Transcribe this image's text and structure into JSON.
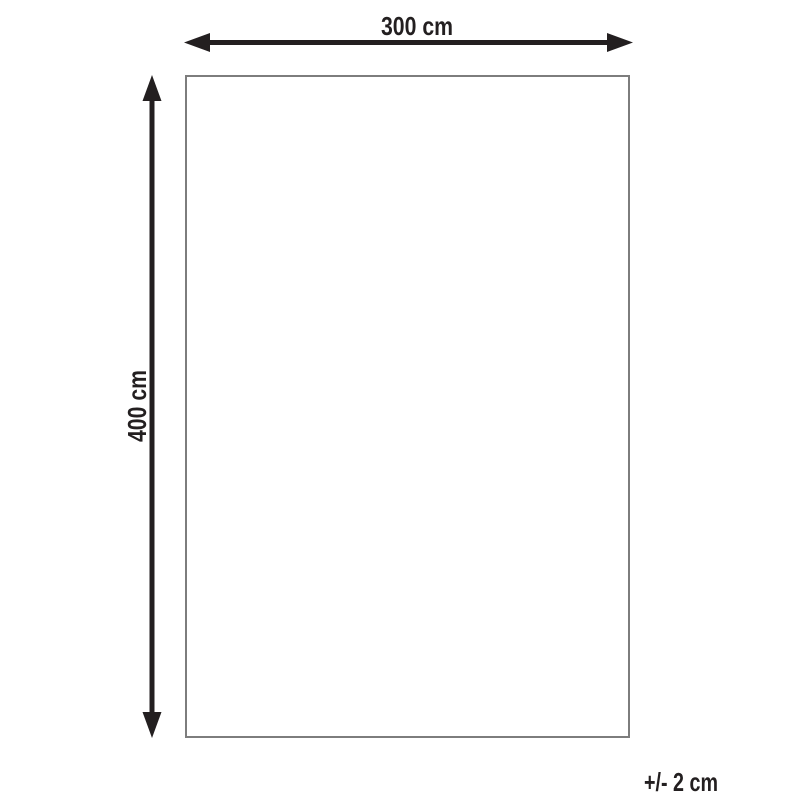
{
  "diagram": {
    "type": "product-dimension-diagram",
    "width_label": "300 cm",
    "height_label": "400 cm",
    "tolerance_label": "+/- 2 cm",
    "colors": {
      "arrow": "#231f20",
      "text": "#231f20",
      "outline": "#7d7d7d",
      "background": "#ffffff"
    }
  }
}
